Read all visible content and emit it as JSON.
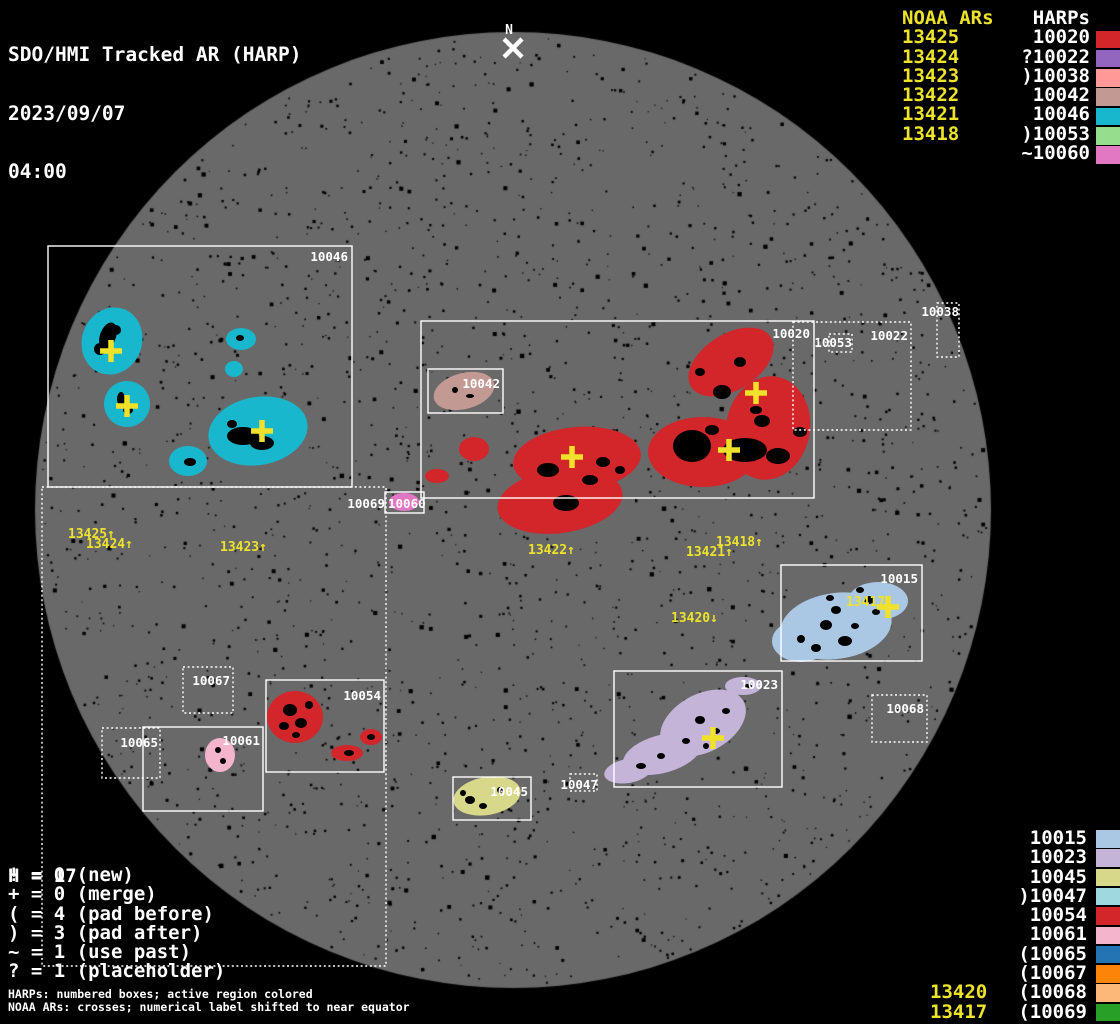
{
  "title": {
    "line1": "SDO/HMI Tracked AR (HARP)",
    "date": "2023/09/07",
    "time": "04:00"
  },
  "colors": {
    "background": "#000000",
    "disk": "#696969",
    "white": "#ffffff",
    "noaa_yellow": "#ece32a",
    "cross_yellow": "#f0e22b"
  },
  "north_marker": {
    "label": "N",
    "x": 509,
    "label_y": 34,
    "cross_x": 513,
    "cross_y": 48
  },
  "legend_top": {
    "noaa_header": "NOAA ARs",
    "harp_header": "HARPs",
    "rows": [
      {
        "noaa": "13425",
        "harp": " 10020",
        "color": "#d2262b"
      },
      {
        "noaa": "13424",
        "harp": "?10022",
        "color": "#9266be"
      },
      {
        "noaa": "13423",
        "harp": ")10038",
        "color": "#fe9997"
      },
      {
        "noaa": "13422",
        "harp": " 10042",
        "color": "#c29a93"
      },
      {
        "noaa": "13421",
        "harp": " 10046",
        "color": "#19b7cd"
      },
      {
        "noaa": "13418",
        "harp": ")10053",
        "color": "#96dd8e"
      },
      {
        "noaa": "",
        "harp": "~10060",
        "color": "#e277c3"
      }
    ]
  },
  "legend_bottom": {
    "rows": [
      {
        "noaa": "",
        "harp": " 10015",
        "color": "#aac7e4"
      },
      {
        "noaa": "",
        "harp": " 10023",
        "color": "#c4b4d8"
      },
      {
        "noaa": "",
        "harp": " 10045",
        "color": "#d8d88a"
      },
      {
        "noaa": "",
        "harp": ")10047",
        "color": "#a0d8e0"
      },
      {
        "noaa": "",
        "harp": " 10054",
        "color": "#d2262b"
      },
      {
        "noaa": "",
        "harp": " 10061",
        "color": "#f4b4cc"
      },
      {
        "noaa": "",
        "harp": "(10065",
        "color": "#2474b4"
      },
      {
        "noaa": "",
        "harp": "(10067",
        "color": "#fc8408"
      },
      {
        "noaa": "13420",
        "harp": "(10068",
        "color": "#fcb878"
      },
      {
        "noaa": "13417",
        "harp": "(10069",
        "color": "#28a028"
      }
    ]
  },
  "stats": {
    "h_line": "H = 17",
    "lines": [
      "! = 0 (new)",
      "+ = 0 (merge)",
      "( = 4 (pad before)",
      ") = 3 (pad after)",
      "~ = 1 (use past)",
      "? = 1 (placeholder)"
    ]
  },
  "footnotes": [
    "HARPs: numbered boxes; active region colored",
    "NOAA ARs: crosses; numerical label shifted to near equator"
  ],
  "disk": {
    "cx": 513,
    "cy": 510,
    "r": 478
  },
  "harp_boxes": [
    {
      "id": "10046",
      "x": 48,
      "y": 246,
      "w": 304,
      "h": 241,
      "style": "solid",
      "label": {
        "x": 348,
        "y": 261,
        "anchor": "end"
      }
    },
    {
      "id": "10020",
      "x": 421,
      "y": 321,
      "w": 393,
      "h": 177,
      "style": "solid",
      "label": {
        "x": 810,
        "y": 338,
        "anchor": "end"
      }
    },
    {
      "id": "10042",
      "x": 428,
      "y": 369,
      "w": 75,
      "h": 44,
      "style": "solid",
      "label": {
        "x": 500,
        "y": 388,
        "anchor": "end"
      }
    },
    {
      "id": "10022",
      "x": 793,
      "y": 322,
      "w": 118,
      "h": 108,
      "style": "dotted",
      "label": {
        "x": 908,
        "y": 340,
        "anchor": "end"
      }
    },
    {
      "id": "10053",
      "x": 829,
      "y": 334,
      "w": 23,
      "h": 18,
      "style": "dotted",
      "label": {
        "x": 852,
        "y": 347,
        "anchor": "end"
      }
    },
    {
      "id": "10038",
      "x": 937,
      "y": 303,
      "w": 22,
      "h": 54,
      "style": "dotted",
      "label": {
        "x": 959,
        "y": 316,
        "anchor": "end"
      }
    },
    {
      "id": "10015",
      "x": 781,
      "y": 565,
      "w": 141,
      "h": 96,
      "style": "solid",
      "label": {
        "x": 918,
        "y": 583,
        "anchor": "end"
      }
    },
    {
      "id": "10023",
      "x": 614,
      "y": 671,
      "w": 168,
      "h": 116,
      "style": "solid",
      "label": {
        "x": 778,
        "y": 689,
        "anchor": "end"
      }
    },
    {
      "id": "10045",
      "x": 453,
      "y": 777,
      "w": 78,
      "h": 43,
      "style": "solid",
      "label": {
        "x": 528,
        "y": 796,
        "anchor": "end"
      }
    },
    {
      "id": "10047",
      "x": 570,
      "y": 774,
      "w": 27,
      "h": 17,
      "style": "dotted",
      "label": {
        "x": 598,
        "y": 789,
        "anchor": "end"
      }
    },
    {
      "id": "10068",
      "x": 872,
      "y": 695,
      "w": 55,
      "h": 47,
      "style": "dotted",
      "label": {
        "x": 924,
        "y": 713,
        "anchor": "end"
      }
    },
    {
      "id": "10065",
      "x": 102,
      "y": 728,
      "w": 58,
      "h": 50,
      "style": "dotted",
      "label": {
        "x": 158,
        "y": 747,
        "anchor": "end"
      }
    },
    {
      "id": "10067",
      "x": 183,
      "y": 667,
      "w": 50,
      "h": 46,
      "style": "dotted",
      "label": {
        "x": 230,
        "y": 685,
        "anchor": "end"
      }
    },
    {
      "id": "10061",
      "x": 143,
      "y": 727,
      "w": 120,
      "h": 84,
      "style": "solid",
      "label": {
        "x": 260,
        "y": 745,
        "anchor": "end"
      }
    },
    {
      "id": "10054",
      "x": 266,
      "y": 680,
      "w": 118,
      "h": 92,
      "style": "solid",
      "label": {
        "x": 381,
        "y": 700,
        "anchor": "end"
      }
    },
    {
      "id": "10069",
      "x": 42,
      "y": 487,
      "w": 344,
      "h": 479,
      "style": "dotted",
      "label": {
        "x": 385,
        "y": 508,
        "anchor": "end"
      }
    },
    {
      "id": "10060",
      "x": 385,
      "y": 492,
      "w": 39,
      "h": 21,
      "style": "solid",
      "label": {
        "x": 388,
        "y": 508,
        "anchor": "start"
      }
    }
  ],
  "regions": [
    {
      "harp": "10046",
      "color": "#19b7cd",
      "ellipses": [
        [
          112,
          341,
          30,
          34,
          20
        ],
        [
          241,
          339,
          15,
          11,
          0
        ],
        [
          234,
          369,
          9,
          8,
          0
        ],
        [
          127,
          404,
          23,
          23,
          0
        ],
        [
          258,
          431,
          50,
          34,
          -10
        ],
        [
          188,
          461,
          19,
          15,
          0
        ]
      ]
    },
    {
      "harp": "10042",
      "color": "#c29a93",
      "ellipses": [
        [
          464,
          391,
          31,
          18,
          -15
        ]
      ]
    },
    {
      "harp": "10020",
      "color": "#d2262b",
      "ellipses": [
        [
          731,
          362,
          47,
          28,
          -32
        ],
        [
          768,
          428,
          42,
          52,
          10
        ],
        [
          703,
          452,
          55,
          35,
          0
        ],
        [
          577,
          459,
          64,
          32,
          -5
        ],
        [
          560,
          501,
          63,
          32,
          -8
        ],
        [
          474,
          449,
          15,
          12,
          0
        ],
        [
          437,
          476,
          12,
          7,
          0
        ]
      ]
    },
    {
      "harp": "10060",
      "color": "#e277c3",
      "ellipses": [
        [
          404,
          502,
          15,
          9,
          0
        ]
      ]
    },
    {
      "harp": "10015",
      "color": "#aac7e4",
      "ellipses": [
        [
          836,
          626,
          56,
          33,
          -8
        ],
        [
          878,
          601,
          30,
          19,
          0
        ],
        [
          801,
          641,
          29,
          21,
          0
        ]
      ]
    },
    {
      "harp": "10023",
      "color": "#c4b4d8",
      "ellipses": [
        [
          703,
          723,
          46,
          29,
          -28
        ],
        [
          662,
          754,
          40,
          19,
          -15
        ],
        [
          628,
          771,
          24,
          12,
          -10
        ],
        [
          743,
          686,
          18,
          9,
          0
        ]
      ]
    },
    {
      "harp": "10045",
      "color": "#d8d88a",
      "ellipses": [
        [
          487,
          796,
          34,
          19,
          -10
        ]
      ]
    },
    {
      "harp": "10054",
      "color": "#d2262b",
      "ellipses": [
        [
          295,
          717,
          28,
          26,
          0
        ],
        [
          371,
          737,
          11,
          8,
          0
        ],
        [
          347,
          753,
          16,
          8,
          0
        ]
      ]
    },
    {
      "harp": "10061",
      "color": "#f4b4cc",
      "ellipses": [
        [
          220,
          755,
          15,
          17,
          0
        ]
      ]
    }
  ],
  "dark_spots": [
    [
      108,
      336,
      8,
      14,
      20
    ],
    [
      100,
      349,
      6,
      6,
      0
    ],
    [
      116,
      330,
      5,
      5,
      0
    ],
    [
      121,
      399,
      4,
      7,
      0
    ],
    [
      128,
      410,
      5,
      4,
      0
    ],
    [
      243,
      436,
      16,
      9,
      0
    ],
    [
      262,
      443,
      12,
      7,
      0
    ],
    [
      232,
      424,
      5,
      4,
      0
    ],
    [
      190,
      462,
      6,
      4,
      0
    ],
    [
      240,
      338,
      4,
      3,
      0
    ],
    [
      455,
      390,
      3,
      3,
      0
    ],
    [
      470,
      396,
      4,
      2,
      0
    ],
    [
      692,
      446,
      19,
      16,
      0
    ],
    [
      745,
      450,
      22,
      12,
      0
    ],
    [
      722,
      392,
      9,
      7,
      0
    ],
    [
      762,
      421,
      8,
      6,
      0
    ],
    [
      778,
      456,
      12,
      8,
      0
    ],
    [
      800,
      432,
      7,
      5,
      0
    ],
    [
      548,
      470,
      11,
      7,
      0
    ],
    [
      566,
      503,
      13,
      8,
      0
    ],
    [
      603,
      462,
      7,
      5,
      0
    ],
    [
      740,
      362,
      6,
      5,
      0
    ],
    [
      700,
      372,
      5,
      4,
      0
    ],
    [
      756,
      410,
      6,
      4,
      0
    ],
    [
      712,
      430,
      7,
      5,
      0
    ],
    [
      590,
      480,
      8,
      5,
      0
    ],
    [
      620,
      470,
      5,
      4,
      0
    ],
    [
      826,
      625,
      6,
      5,
      0
    ],
    [
      845,
      641,
      7,
      5,
      0
    ],
    [
      836,
      610,
      5,
      4,
      0
    ],
    [
      869,
      600,
      5,
      4,
      0
    ],
    [
      816,
      648,
      5,
      4,
      0
    ],
    [
      855,
      626,
      4,
      3,
      0
    ],
    [
      801,
      639,
      4,
      4,
      0
    ],
    [
      876,
      612,
      4,
      3,
      0
    ],
    [
      860,
      590,
      4,
      3,
      0
    ],
    [
      830,
      598,
      4,
      3,
      0
    ],
    [
      700,
      720,
      5,
      4,
      0
    ],
    [
      716,
      731,
      4,
      3,
      0
    ],
    [
      686,
      741,
      4,
      3,
      0
    ],
    [
      661,
      756,
      4,
      3,
      0
    ],
    [
      641,
      766,
      5,
      3,
      0
    ],
    [
      726,
      711,
      4,
      3,
      0
    ],
    [
      706,
      746,
      3,
      3,
      0
    ],
    [
      748,
      686,
      4,
      2,
      0
    ],
    [
      470,
      800,
      5,
      4,
      0
    ],
    [
      483,
      806,
      4,
      3,
      0
    ],
    [
      500,
      790,
      3,
      3,
      0
    ],
    [
      463,
      793,
      3,
      3,
      0
    ],
    [
      290,
      710,
      7,
      6,
      0
    ],
    [
      301,
      723,
      6,
      5,
      0
    ],
    [
      284,
      726,
      5,
      4,
      0
    ],
    [
      309,
      705,
      4,
      4,
      0
    ],
    [
      296,
      735,
      4,
      3,
      0
    ],
    [
      349,
      753,
      5,
      3,
      0
    ],
    [
      371,
      737,
      4,
      3,
      0
    ],
    [
      218,
      750,
      3,
      3,
      0
    ],
    [
      223,
      761,
      3,
      3,
      0
    ]
  ],
  "crosses": [
    [
      111,
      351
    ],
    [
      127,
      406
    ],
    [
      262,
      431
    ],
    [
      572,
      457
    ],
    [
      729,
      450
    ],
    [
      756,
      393
    ],
    [
      888,
      607
    ],
    [
      713,
      738
    ]
  ],
  "noaa_labels": [
    {
      "text": "13425↑",
      "x": 68,
      "y": 538
    },
    {
      "text": "13424↑",
      "x": 86,
      "y": 548
    },
    {
      "text": "13423↑",
      "x": 220,
      "y": 551
    },
    {
      "text": "13422↑",
      "x": 528,
      "y": 554
    },
    {
      "text": "13421↑",
      "x": 686,
      "y": 556
    },
    {
      "text": "13418↑",
      "x": 716,
      "y": 546
    },
    {
      "text": "13420↓",
      "x": 671,
      "y": 622
    },
    {
      "text": "13417↓",
      "x": 846,
      "y": 606
    }
  ]
}
